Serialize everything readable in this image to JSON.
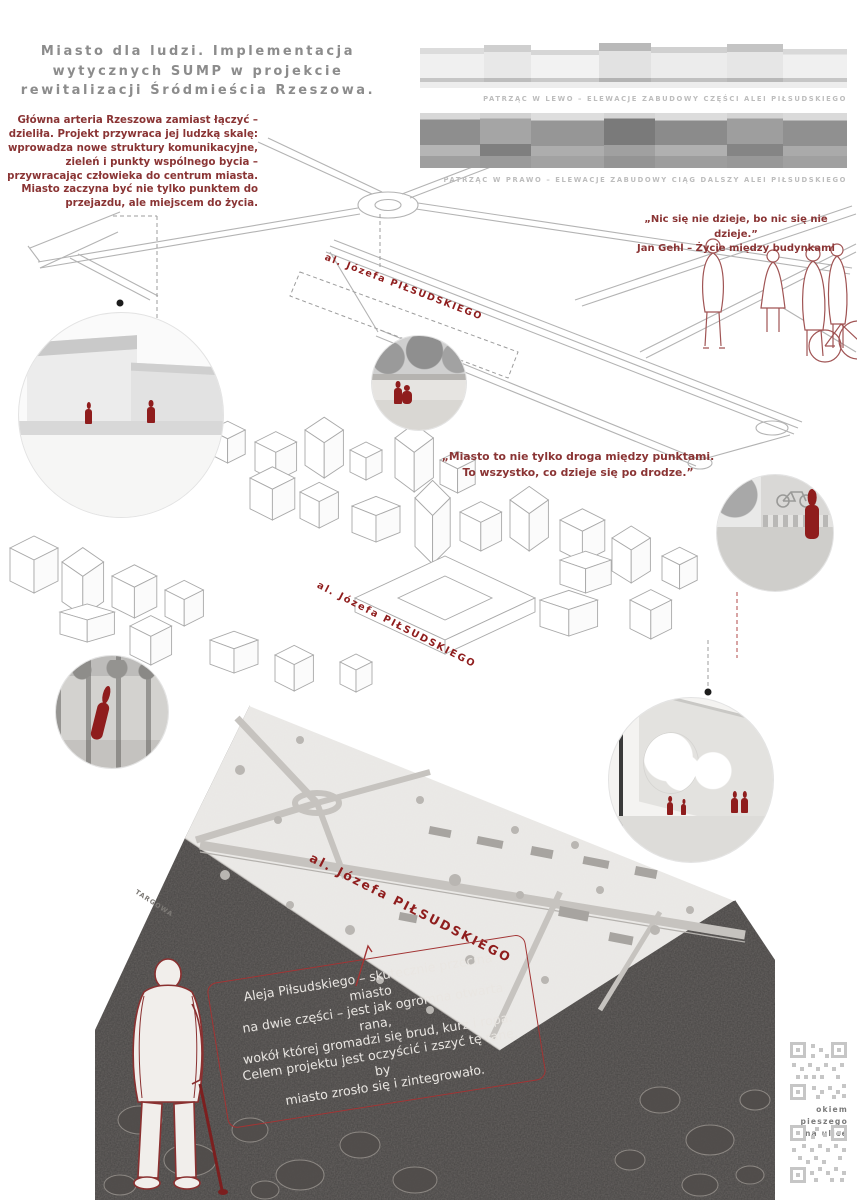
{
  "poster": {
    "title": "Miasto dla ludzi. Implementacja\nwytycznych SUMP w projekcie\nrewitalizacji Śródmieścia Rzeszowa."
  },
  "intro": {
    "text": "Główna arteria Rzeszowa zamiast łączyć – dzieliła. Projekt przywraca jej ludzką skalę: wprowadza nowe struktury komunikacyjne, zieleń i punkty wspólnego bycia – przywracając człowieka do centrum miasta. Miasto zaczyna być nie tylko punktem do przejazdu, ale miejscem do życia."
  },
  "elevations": {
    "caption_left": "PATRZĄC W LEWO – ELEWACJE ZABUDOWY CZĘŚCI ALEI PIŁSUDSKIEGO",
    "caption_right": "PATRZĄC W PRAWO – ELEWACJE ZABUDOWY CIĄG DALSZY ALEI PIŁSUDSKIEGO"
  },
  "quotes": {
    "gehl": "„Nic się nie dzieje, bo nic się nie dzieje.”\nJan Gehl – Życie między budynkami",
    "city": "„Miasto to nie tylko droga między punktami.\nTo wszystko, co dzieje się po drodze.”"
  },
  "labels": {
    "avenue": "al. Józefa PIŁSUDSKIEGO",
    "street_targowa": "TARGOWA"
  },
  "note": {
    "text": "Aleja Piłsudskiego – skutecznie przecina miasto\nna dwie części – jest jak ogromna otwarta rana,\nwokół której gromadzi się brud, kurz i ropa.\nCelem projektu jest oczyścić i zszyć tę ranę, by\nmiasto zrosło się i zintegrowało."
  },
  "qr": {
    "label": "okiem pieszego\nna ulicę"
  },
  "colors": {
    "accent_red": "#8a3434",
    "label_red": "#8f1d1d",
    "title_gray": "#8c8c8c",
    "soil": "#474443"
  }
}
